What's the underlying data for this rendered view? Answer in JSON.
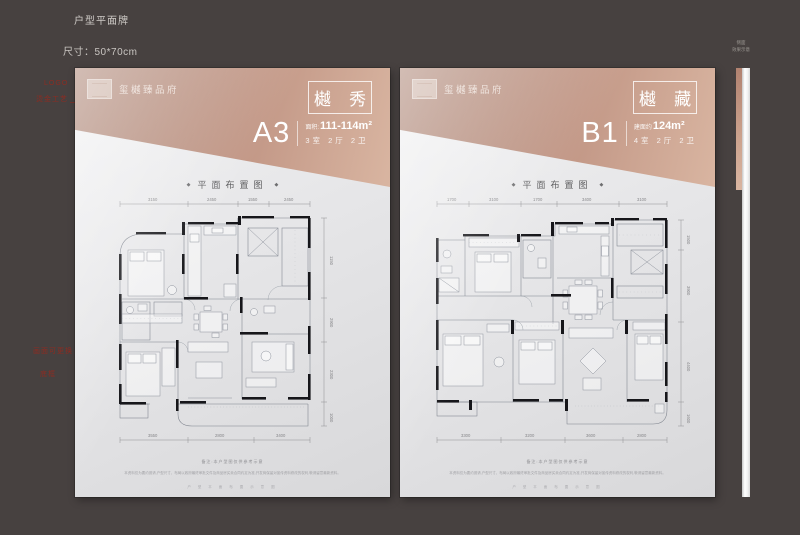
{
  "sheet": {
    "title": "户型平面牌",
    "size_label": "尺寸：50*70cm"
  },
  "notes": {
    "n1": "LOGO",
    "n2": "烫金工艺",
    "n3": "画面可更换",
    "n4": "底框"
  },
  "side": {
    "label_line1": "侧面",
    "label_line2": "效果示意"
  },
  "colors": {
    "canvas_bg": "#474140",
    "copper_dark": "#a57a69",
    "copper_light": "#d9b5a1",
    "note_red": "#8d2c22",
    "panel_bg": "#e6e6e8"
  },
  "panels": [
    {
      "logo_text": "玺樾臻品府",
      "name_label": "樾 秀",
      "unit_code": "A3",
      "area_prefix": "面积:",
      "area_value": "111-114m²",
      "config": "3室 2厅 2卫",
      "plan_heading": "平面布置图",
      "caption": "备注:本户型图仅供参考示意",
      "disclaimer": "本资料仅为要约邀请,户型尺寸、布局以政府最终审批文件及商品房买卖合同约定为准,开发商保留对宣传资料修改的权利,敬请留意最新资料。",
      "footer_row": "户 型 平 面 布 置 示 意 图",
      "dims_top": [
        "3150",
        "2450",
        "1550",
        "2450"
      ],
      "dims_bottom": [
        "3550",
        "2800",
        "3400"
      ],
      "dims_right": [
        "1150",
        "2900",
        "2300",
        "1000"
      ]
    },
    {
      "logo_text": "玺樾臻品府",
      "name_label": "樾 藏",
      "unit_code": "B1",
      "area_prefix": "建面约",
      "area_value": "124m²",
      "config": "4室 2厅 2卫",
      "plan_heading": "平面布置图",
      "caption": "备注:本户型图仅供参考示意",
      "disclaimer": "本资料仅为要约邀请,户型尺寸、布局以政府最终审批文件及商品房买卖合同约定为准,开发商保留对宣传资料修改的权利,敬请留意最新资料。",
      "footer_row": "户 型 平 面 布 置 示 意 图",
      "dims_top": [
        "1700",
        "3100",
        "1700",
        "3400",
        "3100"
      ],
      "dims_bottom": [
        "3300",
        "3200",
        "3600",
        "2800"
      ],
      "dims_right": [
        "1500",
        "3900",
        "4400",
        "1600"
      ]
    }
  ]
}
